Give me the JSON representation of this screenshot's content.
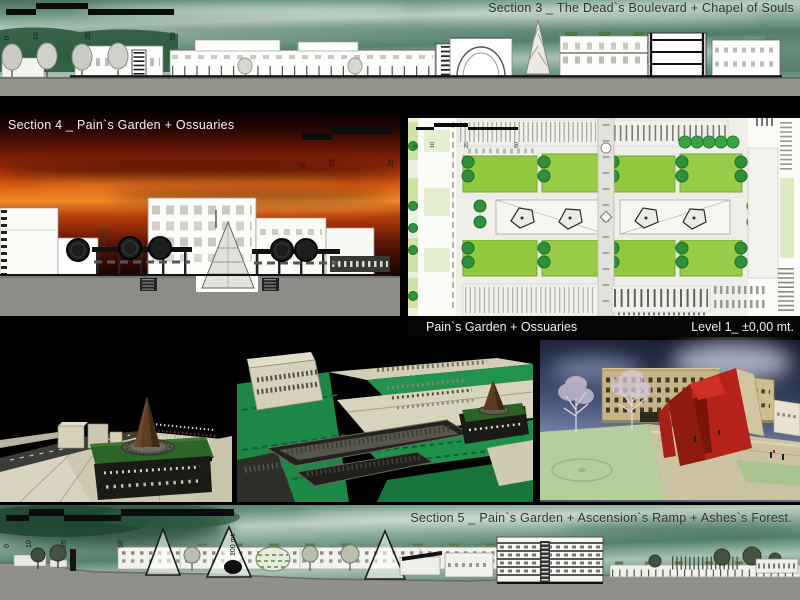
{
  "titles": {
    "section3": "Section 3 _ The Dead`s Boulevard + Chapel of Souls",
    "section4": "Section 4 _ Pain`s Garden + Ossuaries",
    "section5": "Section 5 _ Pain`s Garden + Ascension`s Ramp + Ashes`s Forest."
  },
  "plan": {
    "caption_left": "Pain`s Garden + Ossuaries",
    "caption_right": "Level 1_ ±0,00 mt."
  },
  "scales": {
    "section3": [
      "0",
      "10",
      "25",
      "50"
    ],
    "section4": [
      "0",
      "10",
      "25"
    ],
    "plan": [
      "0",
      "10",
      "25",
      "50"
    ],
    "section5": [
      "0",
      "10",
      "25",
      "50",
      "100 mt."
    ]
  },
  "colors": {
    "board_bg": "#000000",
    "sky_teal": "#6c9480",
    "sunset_orange": "#e06414",
    "sunset_red": "#a02c0a",
    "plan_lawn_green": "#90c83e",
    "plan_tree_green": "#2e9139",
    "drawing_ground_gray": "#909089",
    "model_roof_green": "#2d6428",
    "model_cone_brown": "#5e3d22",
    "render_red": "#b5231a",
    "caption_bg": "#050505",
    "caption_text": "#f0f0ed",
    "title_dark": "#2e342f",
    "title_light": "#f2f2f0"
  }
}
